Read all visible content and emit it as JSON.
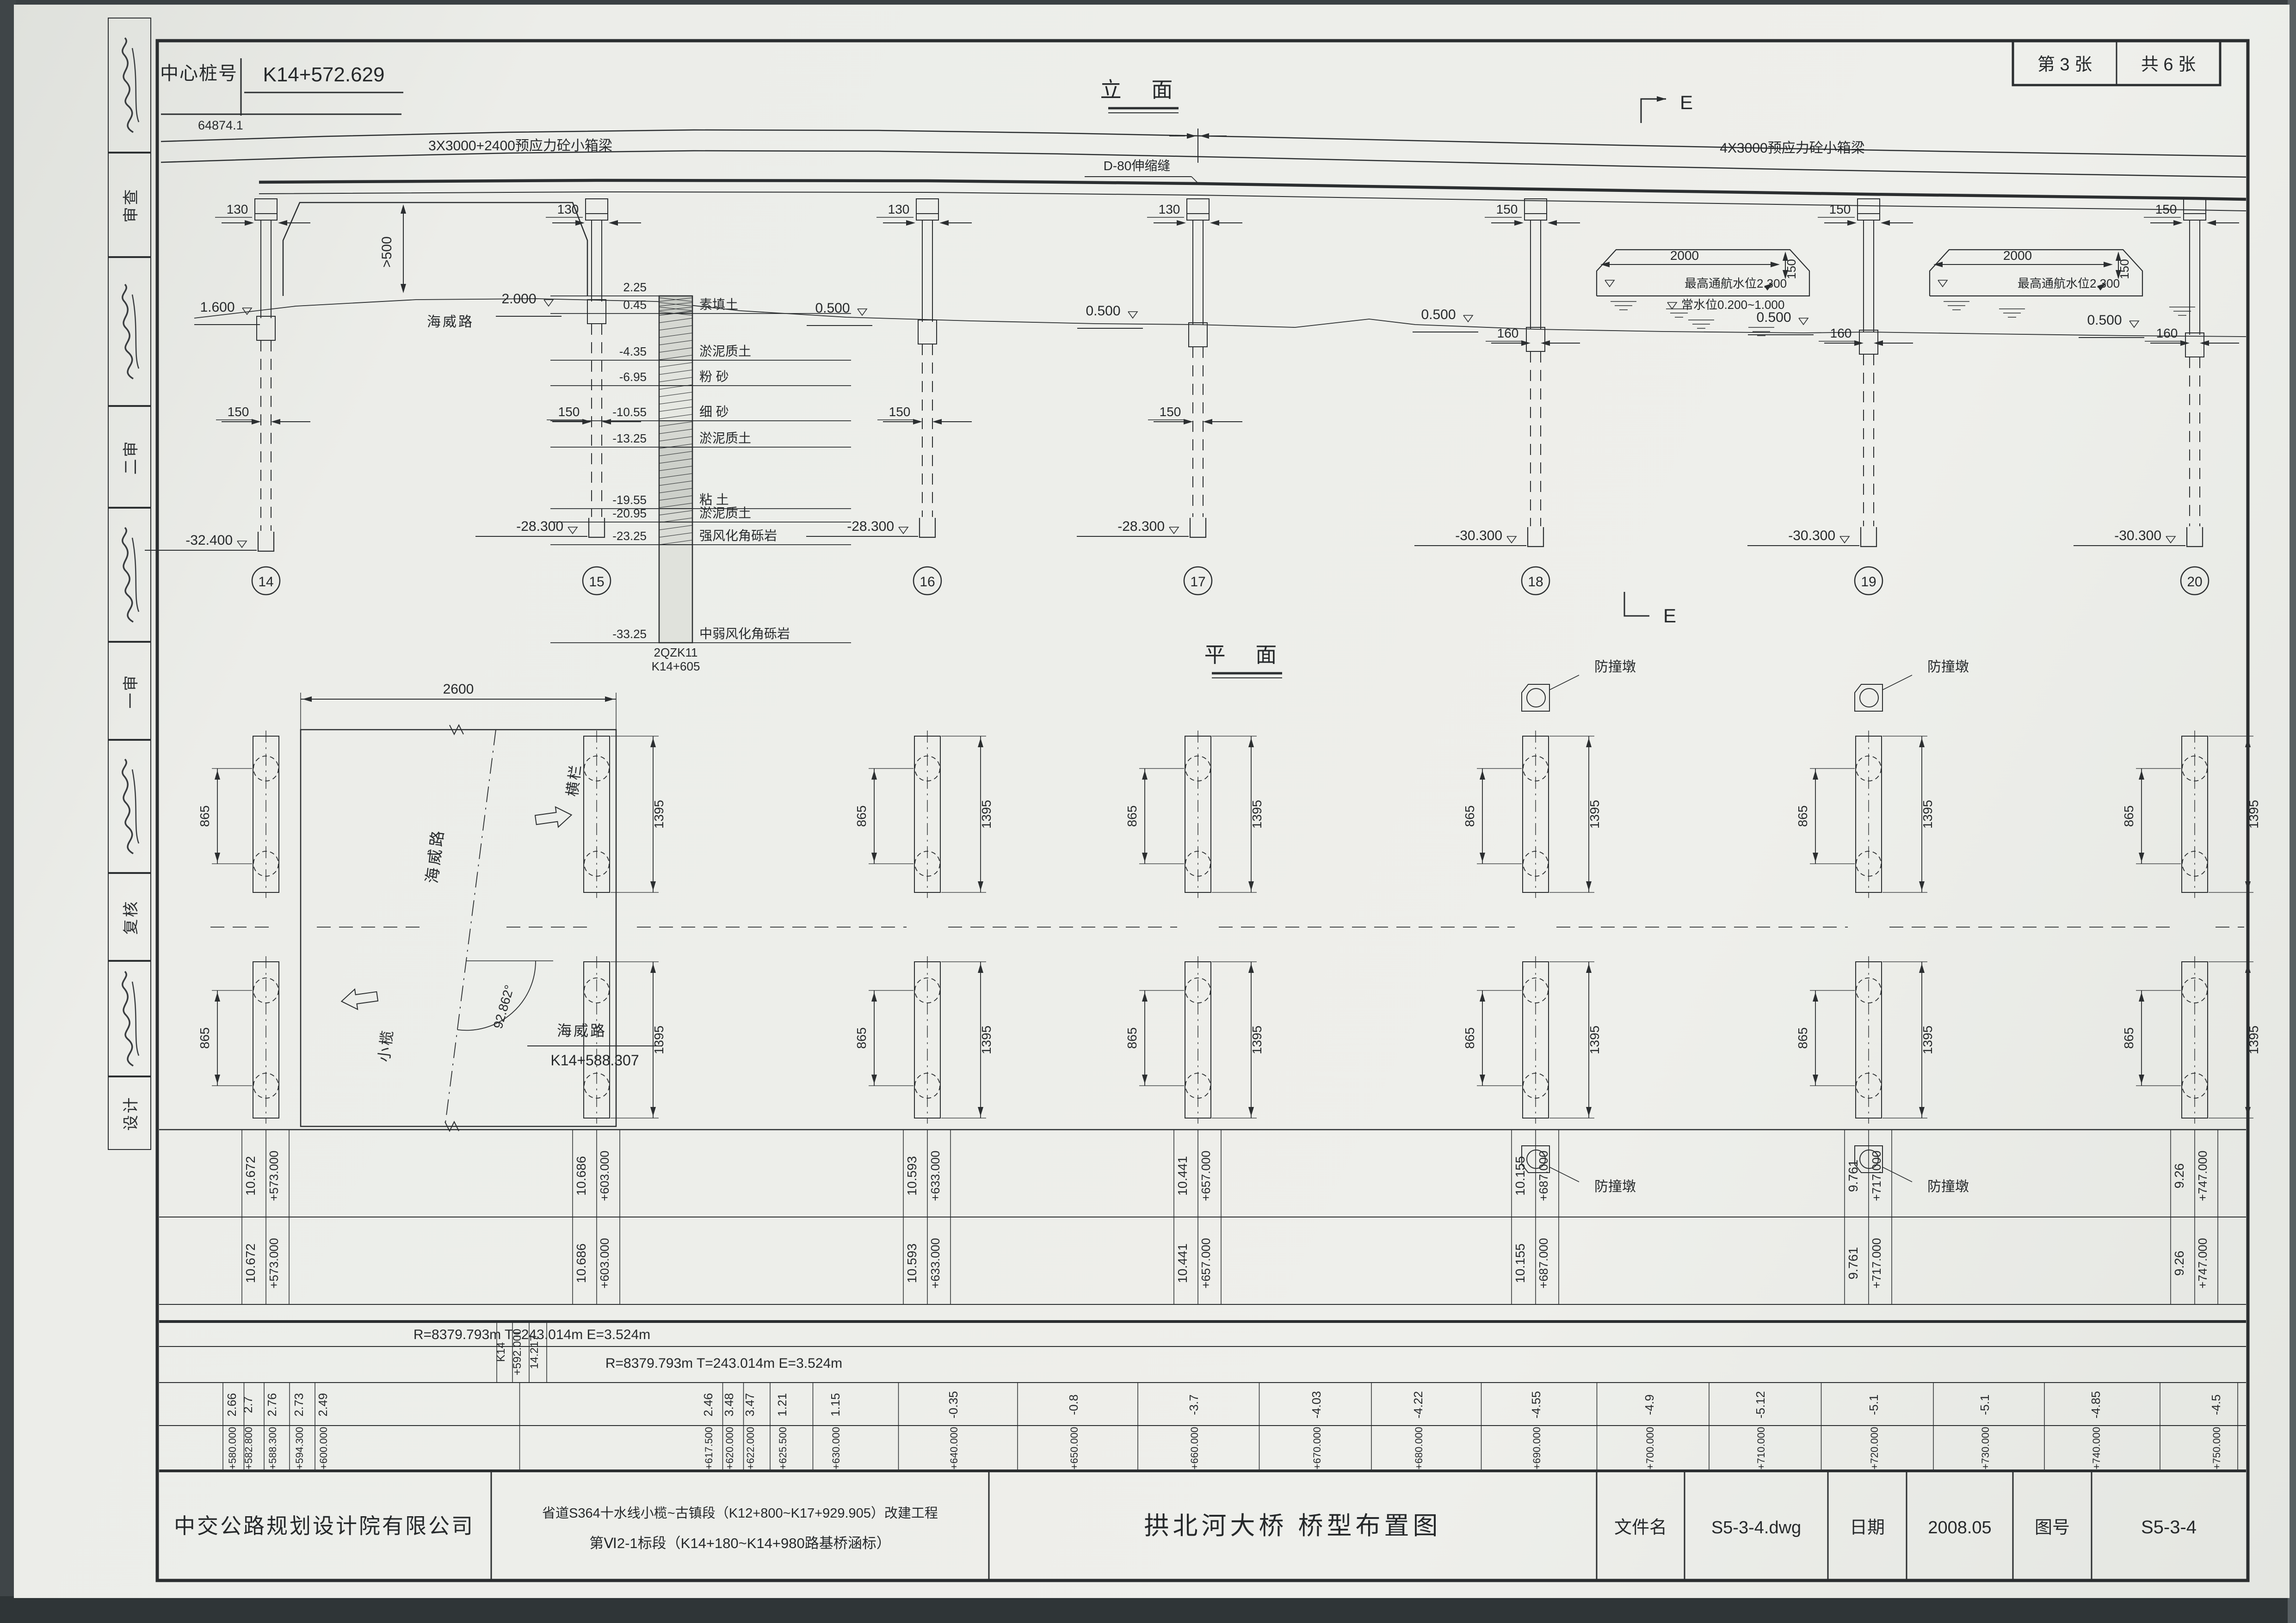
{
  "page": {
    "sheet_no": "第 3 张",
    "sheet_total": "共 6 张"
  },
  "header": {
    "center_pile_label": "中心桩号",
    "center_pile_value": "K14+572.629",
    "total_length": "64874.1"
  },
  "elevation": {
    "title": "立  面",
    "girder_left": "3X3000+2400预应力砼小箱梁",
    "girder_right": "4X3000预应力砼小箱梁",
    "expansion_joint": "D-80伸缩缝",
    "clearance": ">500",
    "underpass_road": "海威路",
    "section_mark": "E",
    "ground_levels": {
      "left_abutment": "1.600",
      "right_of_underpass": "2.000",
      "water": "0.500"
    },
    "piers": [
      {
        "no": "14",
        "tip_elev": "-32.400",
        "cap_width": "130",
        "stem_width": "150"
      },
      {
        "no": "15",
        "tip_elev": "-28.300",
        "cap_width": "130",
        "stem_width": "150"
      },
      {
        "no": "16",
        "tip_elev": "-28.300",
        "cap_width": "130",
        "stem_width": "150"
      },
      {
        "no": "17",
        "tip_elev": "-28.300",
        "cap_width": "130",
        "stem_width": "150"
      },
      {
        "no": "18",
        "tip_elev": "-30.300",
        "cap_width": "150",
        "stem_width": "160"
      },
      {
        "no": "19",
        "tip_elev": "-30.300",
        "cap_width": "150",
        "stem_width": "160"
      },
      {
        "no": "20",
        "tip_elev": "-30.300",
        "cap_width": "150",
        "stem_width": "160"
      }
    ],
    "navigation": {
      "width": "2000",
      "height": "150",
      "high_level": "最高通航水位2.300",
      "normal_level": "常水位0.200~1.000"
    },
    "borehole": {
      "surface_elev": "2.25",
      "id": "2QZK11",
      "station": "K14+605",
      "layers": [
        {
          "elev": "0.45",
          "name": "素填土"
        },
        {
          "elev": "-4.35",
          "name": "淤泥质土"
        },
        {
          "elev": "-6.95",
          "name": "粉 砂"
        },
        {
          "elev": "-10.55",
          "name": "细 砂"
        },
        {
          "elev": "-13.25",
          "name": "淤泥质土"
        },
        {
          "elev": "-19.55",
          "name": "粘 土"
        },
        {
          "elev": "-20.95",
          "name": "淤泥质土"
        },
        {
          "elev": "-23.25",
          "name": "强风化角砾岩"
        },
        {
          "elev": "-33.25",
          "name": "中弱风化角砾岩"
        }
      ]
    }
  },
  "plan": {
    "title": "平  面",
    "deck_width": "2600",
    "road_name": "海威路",
    "crossing_angle": "92.862°",
    "crossing_station": "K14+588.307",
    "direction_right": "横栏",
    "direction_left": "小榄",
    "pile_spacing": "865",
    "pile_group_extent": "1395",
    "dolphin_label": "防撞墩"
  },
  "profile": {
    "deck_elevations": [
      {
        "value": "10.672",
        "station": "+573.000"
      },
      {
        "value": "10.686",
        "station": "+603.000"
      },
      {
        "value": "10.593",
        "station": "+633.000"
      },
      {
        "value": "10.441",
        "station": "+657.000"
      },
      {
        "value": "10.155",
        "station": "+687.000"
      },
      {
        "value": "9.761",
        "station": "+717.000"
      },
      {
        "value": "9.26",
        "station": "+747.000"
      }
    ],
    "curve_note": "R=8379.793m T=243.014m E=3.524m",
    "vc_prefix": "K14",
    "vc_station": "+592.000",
    "vc_elevation": "14.217",
    "grades": [
      {
        "grade": "2.66",
        "station": "+580.000"
      },
      {
        "grade": "2.7",
        "station": "+582.800"
      },
      {
        "grade": "2.76",
        "station": "+588.300"
      },
      {
        "grade": "2.73",
        "station": "+594.300"
      },
      {
        "grade": "2.49",
        "station": "+600.000"
      },
      {
        "grade": "2.46",
        "station": "+617.500"
      },
      {
        "grade": "3.48",
        "station": "+620.000"
      },
      {
        "grade": "3.47",
        "station": "+622.000"
      },
      {
        "grade": "1.21",
        "station": "+625.500"
      },
      {
        "grade": "1.15",
        "station": "+630.000"
      },
      {
        "grade": "-0.35",
        "station": "+640.000"
      },
      {
        "grade": "-0.8",
        "station": "+650.000"
      },
      {
        "grade": "-3.7",
        "station": "+660.000"
      },
      {
        "grade": "-4.03",
        "station": "+670.000"
      },
      {
        "grade": "-4.22",
        "station": "+680.000"
      },
      {
        "grade": "-4.55",
        "station": "+690.000"
      },
      {
        "grade": "-4.9",
        "station": "+700.000"
      },
      {
        "grade": "-5.12",
        "station": "+710.000"
      },
      {
        "grade": "-5.1",
        "station": "+720.000"
      },
      {
        "grade": "-5.1",
        "station": "+730.000"
      },
      {
        "grade": "-4.85",
        "station": "+740.000"
      },
      {
        "grade": "-4.5",
        "station": "+750.000"
      }
    ]
  },
  "titleblock": {
    "company": "中交公路规划设计院有限公司",
    "project_line1": "省道S364十水线小榄~古镇段（K12+800~K17+929.905）改建工程",
    "project_line2": "第Ⅵ2-1标段（K14+180~K14+980路基桥涵标）",
    "drawing_title": "拱北河大桥 桥型布置图",
    "file_label": "文件名",
    "file_value": "S5-3-4.dwg",
    "date_label": "日期",
    "date_value": "2008.05",
    "number_label": "图号",
    "number_value": "S5-3-4"
  },
  "sidebar": {
    "labels": [
      "审查",
      "二审",
      "一审",
      "复核",
      "设计"
    ]
  }
}
